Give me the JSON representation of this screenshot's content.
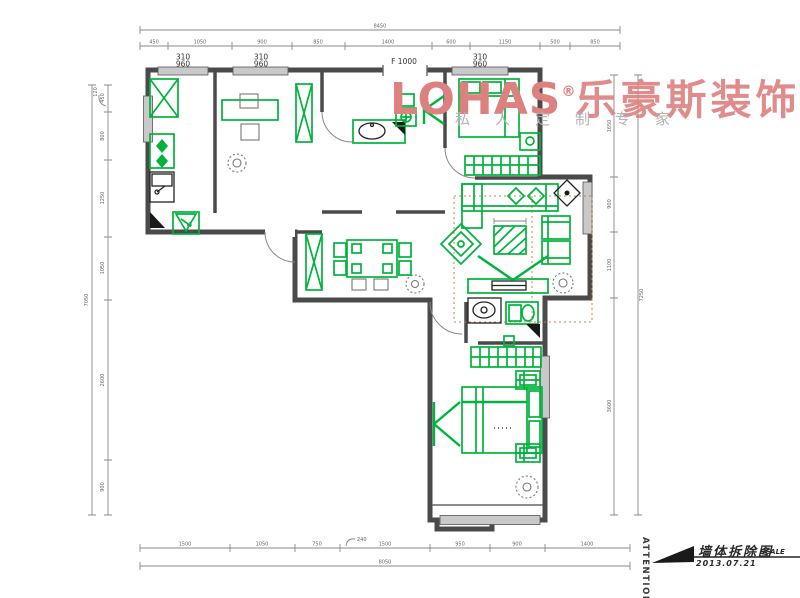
{
  "watermark": {
    "brand": "LOHAS",
    "registered": "®",
    "brand_cn": "乐豪斯装饰",
    "tagline": "私人定制专家"
  },
  "title_block": {
    "attention": "ATTENTION",
    "title": "墙体拆除图",
    "date": "2013.07.21",
    "scale_label": "SCALE"
  },
  "plan_labels": {
    "window_width": "310",
    "window_height": "960",
    "door": "F 1000"
  },
  "dims": {
    "top_total": "8450",
    "top": [
      "450",
      "1050",
      "900",
      "850",
      "1400",
      "600",
      "1150",
      "500",
      "850"
    ],
    "left_total": "7050",
    "left": [
      "450",
      "800",
      "1250",
      "1050",
      "2600",
      "900"
    ],
    "left_leader": "120",
    "right_total": "7250",
    "right": [
      "1650",
      "900",
      "1100",
      "3600"
    ],
    "bottom_total": "8050",
    "bottom": [
      "1500",
      "1050",
      "750",
      "1500",
      "950",
      "900",
      "1400"
    ],
    "bottom_leader": "240"
  },
  "colors": {
    "wall": "#4a4a4a",
    "furniture_green": "#00b33c",
    "watermark_red": "#dd8080",
    "tagline_gray": "#b3b3b3",
    "rug_dotted": "#c8824b",
    "dimension_gray": "#8a8a8a",
    "window_fill": "#c9c9c9"
  }
}
